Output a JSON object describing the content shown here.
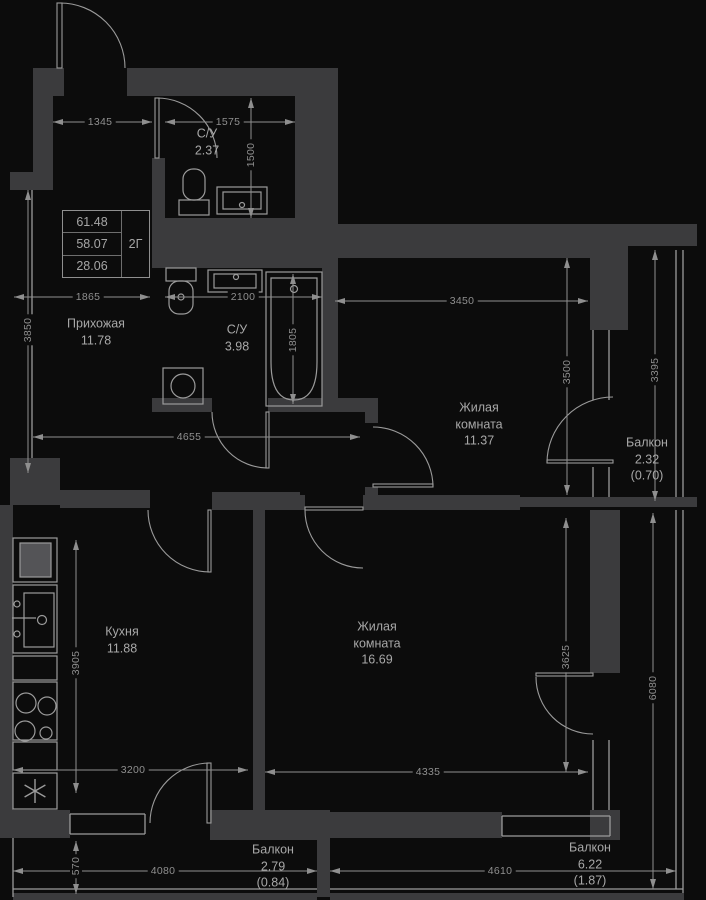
{
  "colors": {
    "wall": "#3b3b3d",
    "fixture_line": "#9b9b9b",
    "dimension": "#8f8f8f",
    "label": "#a8a8a8",
    "background": "#0c0c0c"
  },
  "info_box": {
    "values": [
      "61.48",
      "58.07",
      "28.06"
    ],
    "type_label": "2Г"
  },
  "rooms": [
    {
      "id": "hallway",
      "name": "Прихожая",
      "area": "11.78"
    },
    {
      "id": "bath-small",
      "name": "С/У",
      "area": "2.37"
    },
    {
      "id": "bath",
      "name": "С/У",
      "area": "3.98"
    },
    {
      "id": "living-1",
      "name": "Жилая комната",
      "area": "11.37"
    },
    {
      "id": "kitchen",
      "name": "Кухня",
      "area": "11.88"
    },
    {
      "id": "living-2",
      "name": "Жилая комната",
      "area": "16.69"
    },
    {
      "id": "balcony-1",
      "name": "Балкон",
      "area": "2.32",
      "reduced": "(0.70)"
    },
    {
      "id": "balcony-2",
      "name": "Балкон",
      "area": "2.79",
      "reduced": "(0.84)"
    },
    {
      "id": "balcony-3",
      "name": "Балкон",
      "area": "6.22",
      "reduced": "(1.87)"
    }
  ],
  "dims": {
    "entry_wall": "1345",
    "top_bath_width": "1575",
    "top_bath_height": "1500",
    "hallway_width": "1865",
    "bath_width": "2100",
    "living1_width": "3450",
    "hallway_height": "3850",
    "bathtub_length": "1805",
    "living1_height": "3500",
    "balcony1_height": "3395",
    "hallway_length": "4655",
    "kitchen_height": "3905",
    "kitchen_width": "3200",
    "living2_width": "4335",
    "living2_height": "3625",
    "balcony3_height": "6080",
    "balcony2_depth": "570",
    "balcony2_width": "4080",
    "balcony3_width": "4610"
  }
}
